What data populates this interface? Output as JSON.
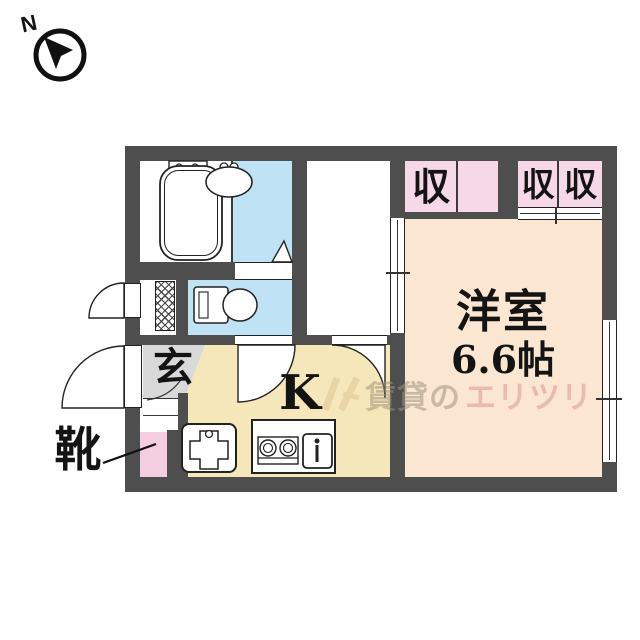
{
  "compass": {
    "label": "N"
  },
  "rooms": {
    "storage_a": {
      "label": "収"
    },
    "storage_b1": {
      "label": "収"
    },
    "storage_b2": {
      "label": "収"
    },
    "main_room": {
      "name": "洋室",
      "size": "6.6帖"
    },
    "kitchen": {
      "label": "K"
    },
    "entrance": {
      "label": "玄"
    },
    "shoes": {
      "label": "靴"
    }
  },
  "watermark": {
    "text_left": "賃貸の",
    "text_right": "エリツリ"
  },
  "icons": [
    "north-arrow-icon",
    "bathtub-icon",
    "washbasin-icon",
    "toilet-icon",
    "washing-machine-icon",
    "kitchen-sink-icon",
    "stove-icon",
    "door-swing-arc",
    "sliding-window",
    "folding-door-triangle"
  ],
  "colors": {
    "wall": "#4e4e4e",
    "bath": "#bfe2f4",
    "storage": "#f6d8e9",
    "main": "#fbe6d1",
    "kitchen": "#f5e7b9",
    "genkan": "#d9d9d9",
    "shoebox": "#f3cde0",
    "line": "#1a1a1a"
  }
}
